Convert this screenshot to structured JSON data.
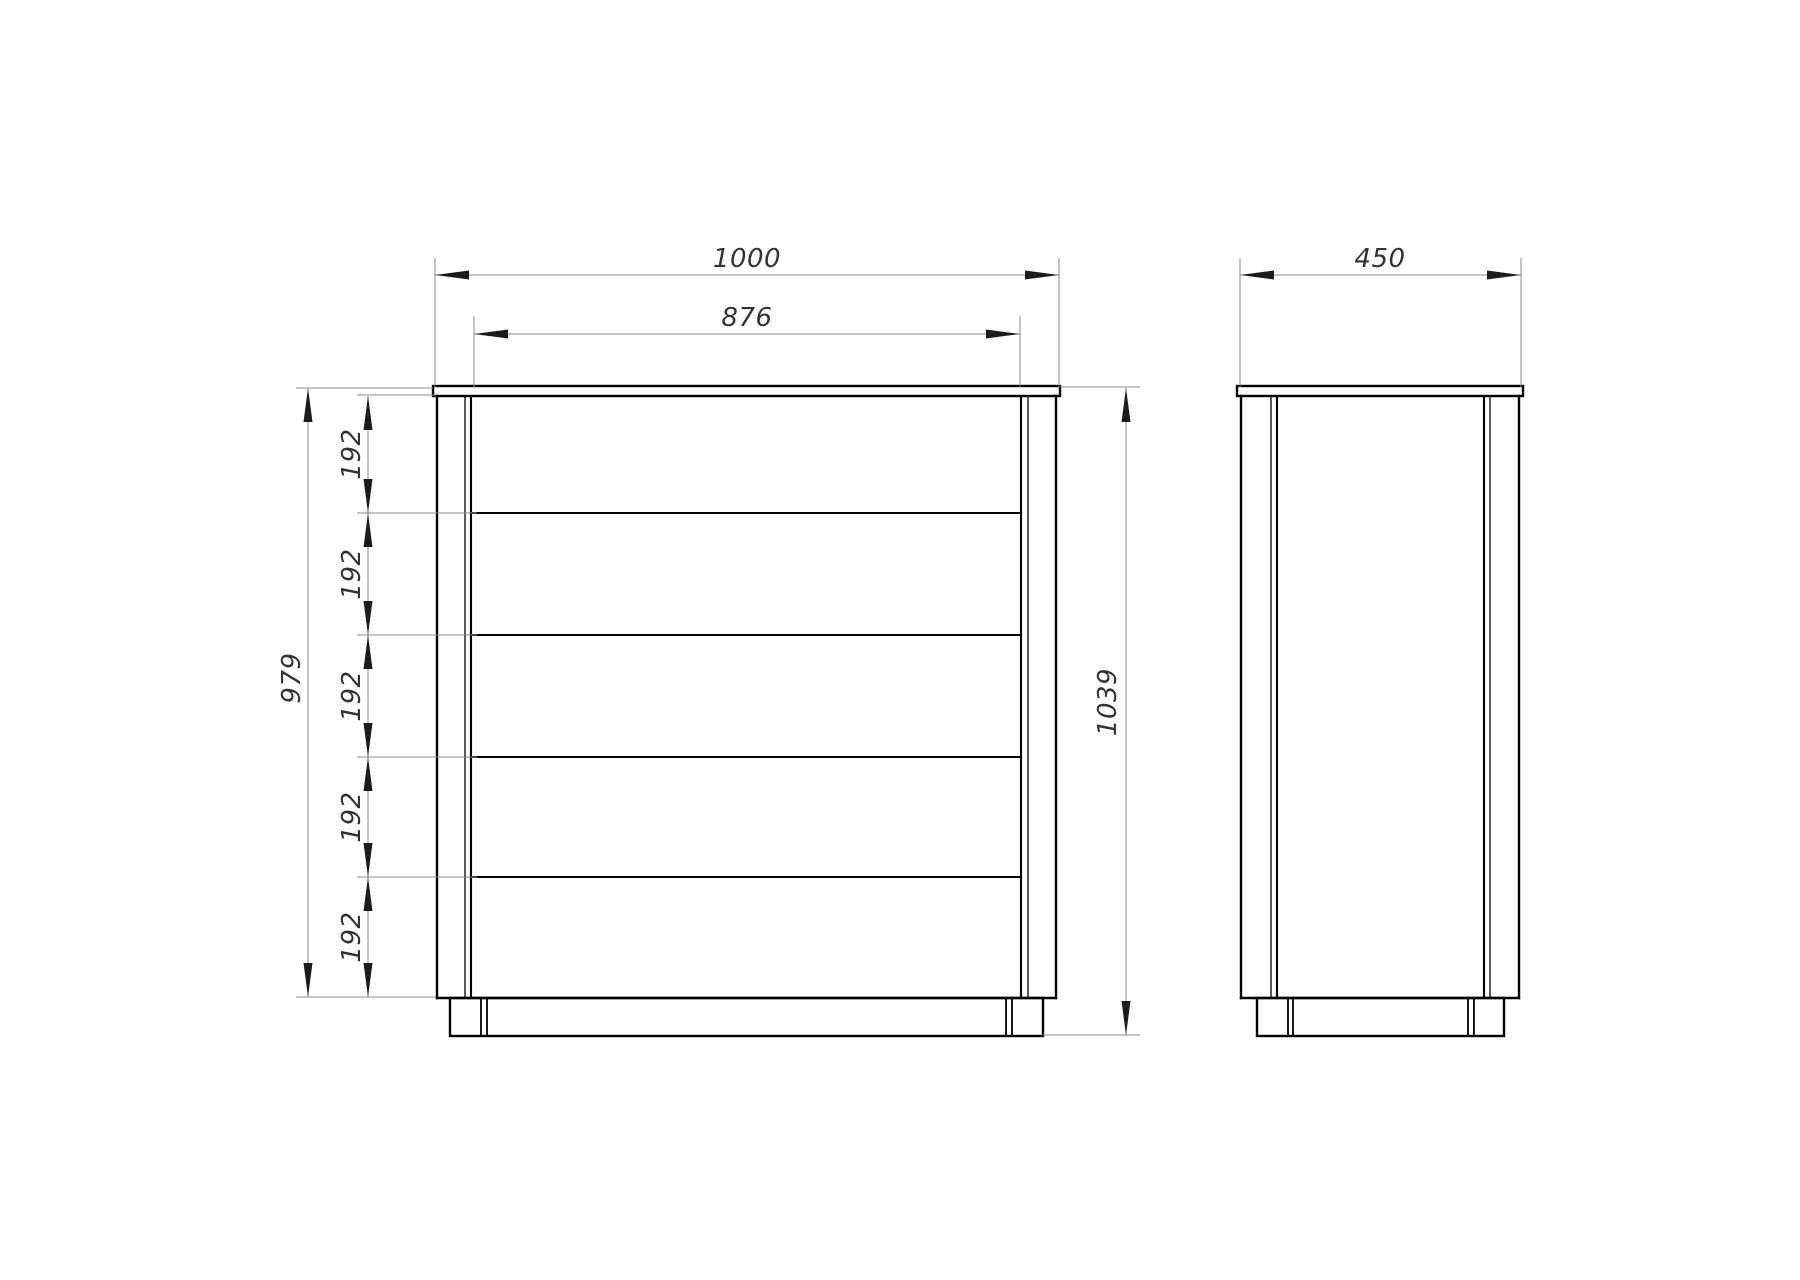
{
  "styles": {
    "background": "#ffffff",
    "geometry_line_color": "#000000",
    "dimension_line_color": "#8a8a8a",
    "dimension_text_color": "#333333"
  },
  "front_view": {
    "name": "dresser-front-view",
    "overall_width": "1000",
    "drawer_front_width": "876",
    "carcass_height": "979",
    "overall_height": "1039",
    "drawer_count": 5,
    "drawer_pitches": [
      "192",
      "192",
      "192",
      "192",
      "192"
    ]
  },
  "side_view": {
    "name": "dresser-side-view",
    "depth": "450"
  }
}
